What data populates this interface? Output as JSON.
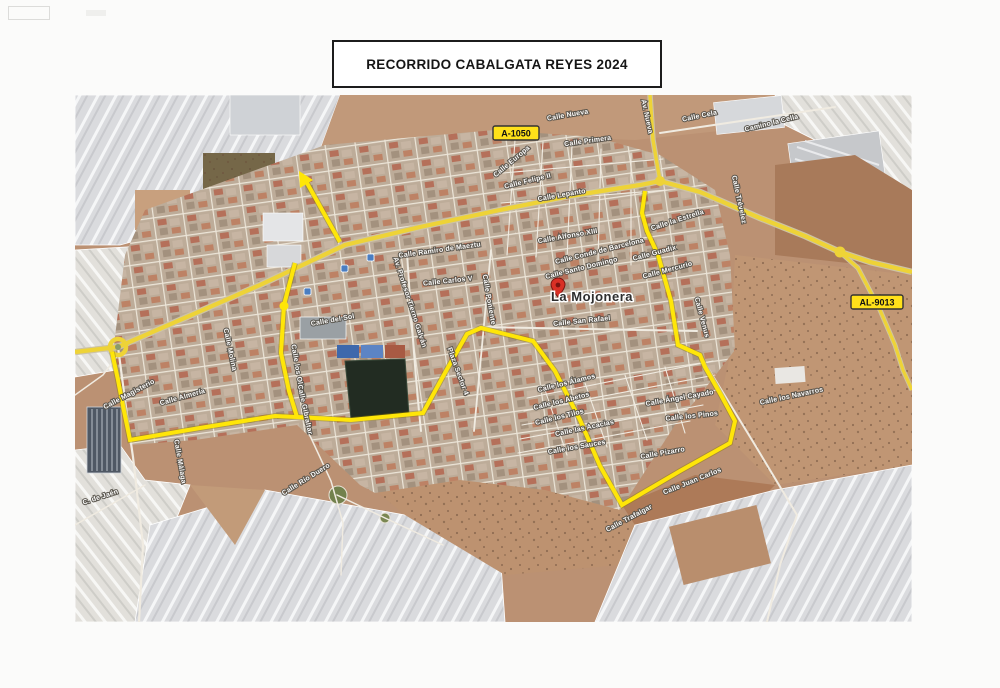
{
  "page": {
    "title": "RECORRIDO CABALGATA REYES 2024"
  },
  "map": {
    "place_label": "La Mojonera",
    "road_badges": {
      "a1050": "A-1050",
      "al9013": "AL-9013"
    },
    "street_labels": [
      {
        "text": "Calle Nueva"
      },
      {
        "text": "Calle Primera"
      },
      {
        "text": "Calle Felipe II"
      },
      {
        "text": "Calle Lepanto"
      },
      {
        "text": "Calle Europa"
      },
      {
        "text": "Av. Nueva"
      },
      {
        "text": "Calle Cela"
      },
      {
        "text": "Camino la Cella"
      },
      {
        "text": "Calle Trévelez"
      },
      {
        "text": "Calle la Estrella"
      },
      {
        "text": "Calle Ramiro de Maeztu"
      },
      {
        "text": "Calle Carlos V"
      },
      {
        "text": "Calle Alfonso XIII"
      },
      {
        "text": "Calle Conde de Barcelona"
      },
      {
        "text": "Calle Santo Domingo"
      },
      {
        "text": "Calle San Rafael"
      },
      {
        "text": "Calle Poniente"
      },
      {
        "text": "Av. Profesor Tierno Galván"
      },
      {
        "text": "Calle del Sol"
      },
      {
        "text": "Calle los Olivos"
      },
      {
        "text": "Calle Gibraltar"
      },
      {
        "text": "Calle Magisterio"
      },
      {
        "text": "Calle Almería"
      },
      {
        "text": "Calle Molina"
      },
      {
        "text": "Calle Málaga"
      },
      {
        "text": "C. de Jaén"
      },
      {
        "text": "Calle Río Duero"
      },
      {
        "text": "Plaza Sector 4"
      },
      {
        "text": "Calle Guadix"
      },
      {
        "text": "Calle Mercurio"
      },
      {
        "text": "Calle Venus"
      },
      {
        "text": "Calle los Álamos"
      },
      {
        "text": "Calle los Abetos"
      },
      {
        "text": "Calle los Tilos"
      },
      {
        "text": "Calle las Acacias"
      },
      {
        "text": "Calle los Sauces"
      },
      {
        "text": "Calle Ángel Cayado"
      },
      {
        "text": "Calle los Pinos"
      },
      {
        "text": "Calle Pizarro"
      },
      {
        "text": "Calle Juan Carlos"
      },
      {
        "text": "Calle Trafalgar"
      },
      {
        "text": "Calle los Navarros"
      }
    ],
    "colors": {
      "route_yellow": "#ffe608",
      "road_yellow": "#eed337",
      "pin_red": "#d93025",
      "transit_blue": "#4a7ec2"
    }
  }
}
